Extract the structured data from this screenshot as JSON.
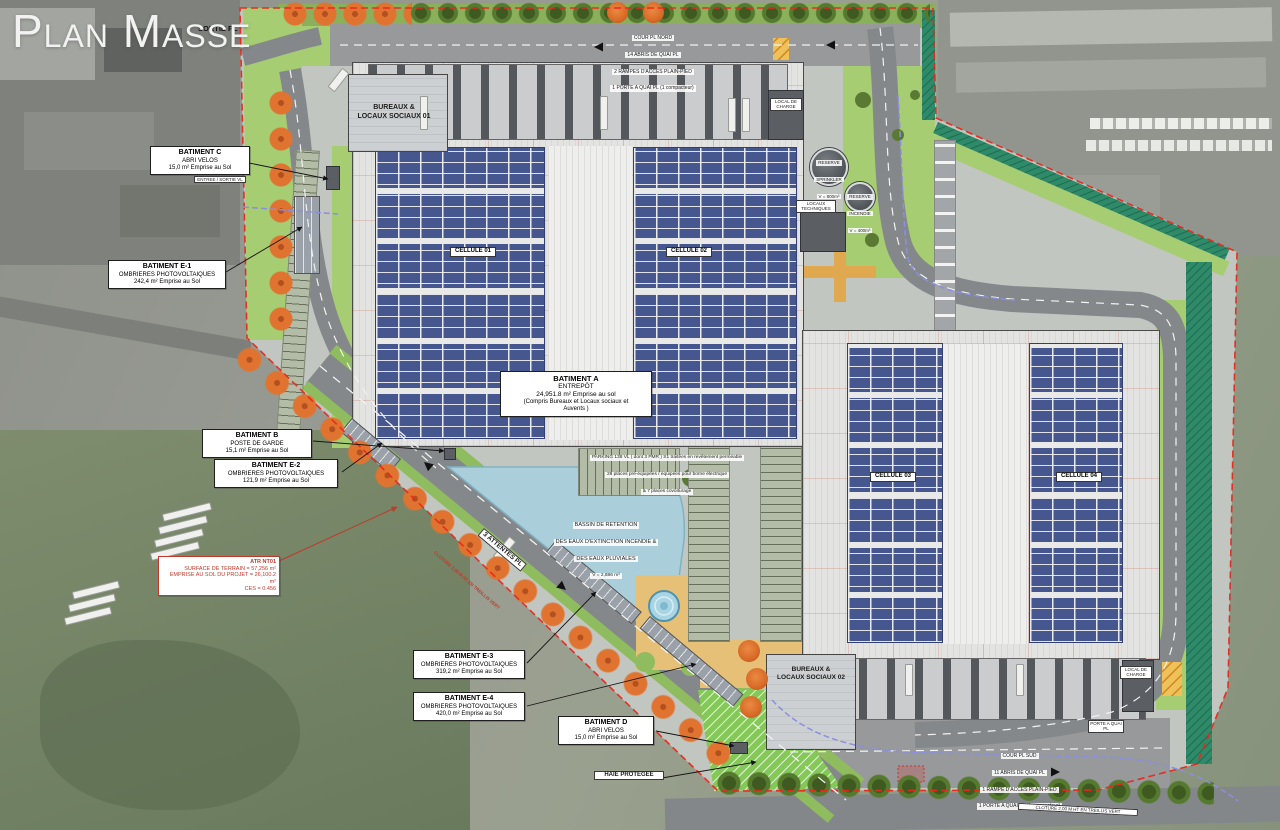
{
  "title": "Plan Masse",
  "colors": {
    "boundary_red": "#e8281c",
    "solar_blue": "#46568e",
    "water_blue": "#abcfda",
    "lawn_green": "#a6cd72",
    "tree_orange": "#e0732f",
    "road_gray": "#85888a"
  },
  "labels": {
    "sortie_pl": "SORTIE PL",
    "entree_sortie_vl": "ENTREE / SORTIE VL",
    "attentes_pl": "3 ATTENTES PL",
    "haie": "HAIE PROTEGEE",
    "cloture": "CLOTURE 2,00 M HT EN TREILLIS VERT",
    "porte_quai": "PORTE A QUAI PL",
    "local_charge": "LOCAL DE CHARGE",
    "locaux_tech": "LOCAUX TECHNIQUES"
  },
  "buildings": {
    "bureaux_01_l1": "BUREAUX &",
    "bureaux_01_l2": "LOCAUX SOCIAUX 01",
    "bureaux_02_l1": "BUREAUX &",
    "bureaux_02_l2": "LOCAUX SOCIAUX 02",
    "cellules": [
      "CELLULE 01",
      "CELLULE 02",
      "CELLULE 03",
      "CELLULE 04"
    ]
  },
  "annotations": {
    "batiment_a": {
      "title": "BATIMENT A",
      "sub": "ENTREPÔT",
      "area": "24,951.8 m² Emprise au sol",
      "note1": "(Compris Bureaux et Locaux sociaux et",
      "note2": "Auvents )"
    },
    "batiment_b": {
      "title": "BATIMENT B",
      "sub": "POSTE DE GARDE",
      "area": "15,1 m² Emprise au Sol"
    },
    "batiment_c": {
      "title": "BATIMENT C",
      "sub": "ABRI VELOS",
      "area": "15,0 m² Emprise au Sol"
    },
    "batiment_d": {
      "title": "BATIMENT D",
      "sub": "ABRI VELOS",
      "area": "15,0 m² Emprise au Sol"
    },
    "batiment_e1": {
      "title": "BATIMENT E-1",
      "sub": "OMBRIERES PHOTOVOLTAIQUES",
      "area": "242,4 m² Emprise au Sol"
    },
    "batiment_e2": {
      "title": "BATIMENT E-2",
      "sub": "OMBRIERES PHOTOVOLTAIQUES",
      "area": "121,9 m² Emprise au Sol"
    },
    "batiment_e3": {
      "title": "BATIMENT E-3",
      "sub": "OMBRIERES PHOTOVOLTAIQUES",
      "area": "319,2 m² Emprise au Sol"
    },
    "batiment_e4": {
      "title": "BATIMENT E-4",
      "sub": "OMBRIERES PHOTOVOLTAIQUES",
      "area": "420,0 m² Emprise au Sol"
    },
    "terrain": {
      "ref": "ATR NT01",
      "l1": "SURFACE DE TERRAIN = 57,256 m²",
      "l2": "EMPRISE AU SOL DU PROJET = 26,100.2 m²",
      "l3": "CES = 0.456"
    }
  },
  "notes": {
    "cour_nord": [
      "COUR PL NORD",
      "14 ABRIS DE QUAI PL",
      "2 RAMPES D'ACCES PLAIN-PIED",
      "1 PORTE A QUAI PL (1 compacteur)"
    ],
    "cour_sud": [
      "COUR PL SUD",
      "11 ABRIS DE QUAI PL",
      "1 RAMPE D'ACCES PLAIN-PIED",
      "1 PORTE A QUAI PL (1 compacteur)"
    ],
    "parking": [
      "PARKING 138 VL ( dont 3 PMR ) S1 traitées en revêtement perméable",
      "28 places pré-équipées / équipées pour borne électrique",
      "& 7 places covoiturage"
    ],
    "bassin": [
      "BASSIN DE RETENTION",
      "DES EAUX D'EXTINCTION INCENDIE &",
      "DES EAUX PLUVIALES",
      "V = 2,886 m³"
    ],
    "reserve_sprinkler": [
      "RESERVE",
      "SPRINKLER",
      "V = 800m³"
    ],
    "reserve_incendie": [
      "RESERVE",
      "INCENDIE",
      "V = 400m³"
    ]
  }
}
